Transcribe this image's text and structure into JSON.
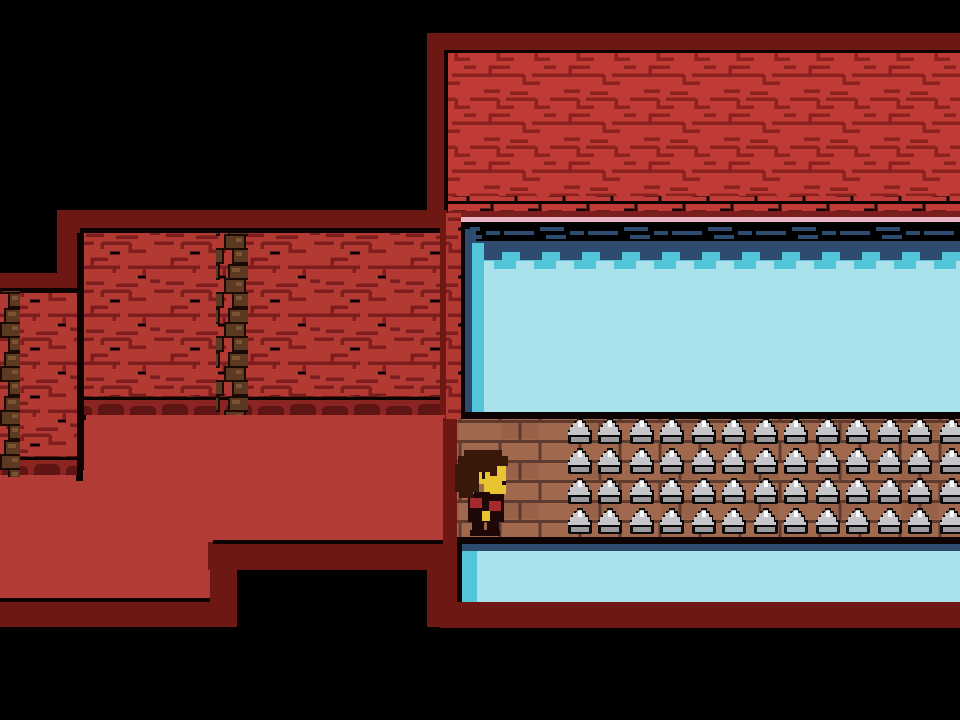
{
  "scene": {
    "description": "pixel-art ruins room with spike bridge over water",
    "character": {
      "name": "human-child-sprite",
      "facing": "right"
    },
    "spikes": {
      "rows": 4,
      "pair_columns": 7,
      "spikes_per_pair": 2
    }
  },
  "colors": {
    "black": "#000000",
    "outline": "#0d0302",
    "maroon": "#6e1813",
    "brick_red": "#c03b35",
    "brick_crack": "#8c2220",
    "brick_red2": "#b23a33",
    "brick_crack2": "#7c1e1d",
    "trim_dark": "#7a1f1e",
    "pink_line": "#eab4c4",
    "navy": "#2e4c70",
    "teal": "#52c6d8",
    "cyan": "#a9e2ea",
    "bridge_base": "#a0694d",
    "bridge_dark": "#5f3b2f",
    "bridge_shade": "#8a5741",
    "shadow_red": "#8a2522",
    "shadow_dark": "#5e1514",
    "vine_dark": "#1c0a04",
    "vine_mid": "#5c3a22",
    "vine_light": "#7d5433",
    "spike_black": "#0a0a0a",
    "spike_grey": "#c6c6ca",
    "spike_mid": "#9b9b9f",
    "spike_light": "#ffffff",
    "floor_red": "#b23c35",
    "hair": "#381808",
    "face": "#e8c431",
    "shirt": "#1f0808",
    "stripe_red": "#a62a2c"
  }
}
